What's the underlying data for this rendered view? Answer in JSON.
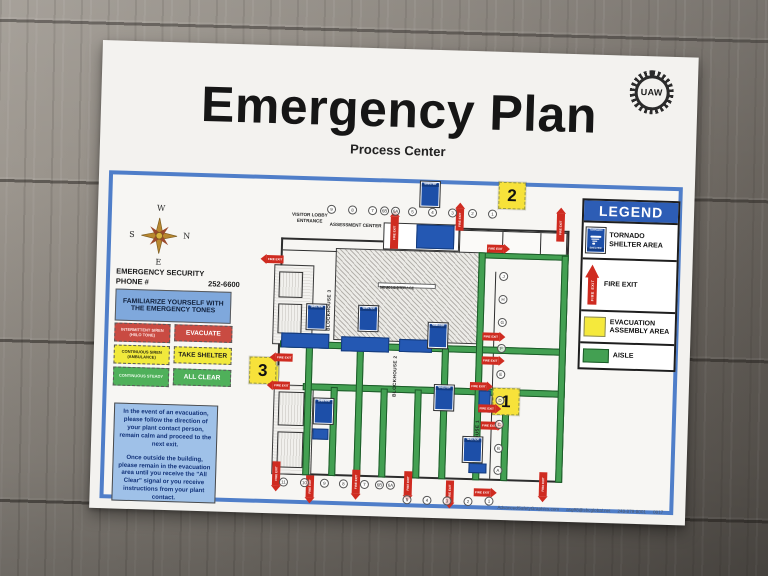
{
  "poster": {
    "title": "Emergency Plan",
    "subtitle": "Process Center",
    "logo_text": "UAW"
  },
  "compass": {
    "n": "N",
    "s": "S",
    "e": "E",
    "w": "W"
  },
  "security": {
    "line1": "EMERGENCY SECURITY",
    "line2": "PHONE #",
    "phone": "252-6600"
  },
  "tones": {
    "header": "FAMILIARIZE YOURSELF WITH THE EMERGENCY TONES",
    "rows": [
      {
        "signal": "INTERMITTENT SIREN (HI/LO TONE)",
        "action": "EVACUATE",
        "color": "#c94b42",
        "signal_color": "#ffe9e7",
        "action_color": "#ffffff"
      },
      {
        "signal": "CONTINUOUS SIREN (AMBULANCE)",
        "action": "TAKE SHELTER",
        "color": "#f1e93c",
        "signal_color": "#2a2a10",
        "action_color": "#1c1c1c"
      },
      {
        "signal": "CONTINUOUS STEADY",
        "action": "ALL CLEAR",
        "color": "#4fb05a",
        "signal_color": "#eafbe9",
        "action_color": "#ffffff"
      }
    ]
  },
  "notice": {
    "para1": "In the event of an evacuation, please follow the direction of your plant contact person, remain calm and proceed to the next exit.",
    "para2": "Once outside the building, please remain in the evacuation area until you receive the \"All Clear\" signal or you receive instructions from your plant contact."
  },
  "legend": {
    "title": "LEGEND",
    "items": [
      {
        "label": "TORNADO SHELTER AREA"
      },
      {
        "label": "FIRE EXIT"
      },
      {
        "label": "EVACUATION ASSEMBLY AREA"
      },
      {
        "label": "AISLE"
      }
    ]
  },
  "map": {
    "visitor_lobby": "VISITOR LOBBY ENTRANCE",
    "assessment": "ASSESSMENT CENTER",
    "vehicle_storage": "VEHICLE STORAGE",
    "vehicle_storage_sub": "147,000 SQ FT",
    "blockhouse1": "BLOCKHOUSE 1",
    "blockhouse2": "BLOCKHOUSE 2",
    "blockhouse3": "BLOCKHOUSE 3",
    "fire_exit": "FIRE EXIT",
    "sign_top": "TORNADO",
    "sign_bottom": "SHELTER",
    "badges": [
      "1",
      "2",
      "3"
    ],
    "top_cols": [
      "9",
      "8",
      "7",
      "6B",
      "6A",
      "5",
      "4",
      "3",
      "2",
      "1"
    ],
    "bottom_cols": [
      "11",
      "10",
      "9",
      "8",
      "7",
      "6B",
      "6A",
      "5",
      "4",
      "3",
      "2",
      "1"
    ],
    "side_rows": [
      "J",
      "H",
      "G",
      "F",
      "E",
      "D",
      "C",
      "B",
      "A"
    ]
  },
  "footer": {
    "site": "AdvancedSafetyGraphics.com",
    "email": "asg98@sbcglobal.net",
    "phone": "248-879-8001",
    "code": "0817"
  }
}
